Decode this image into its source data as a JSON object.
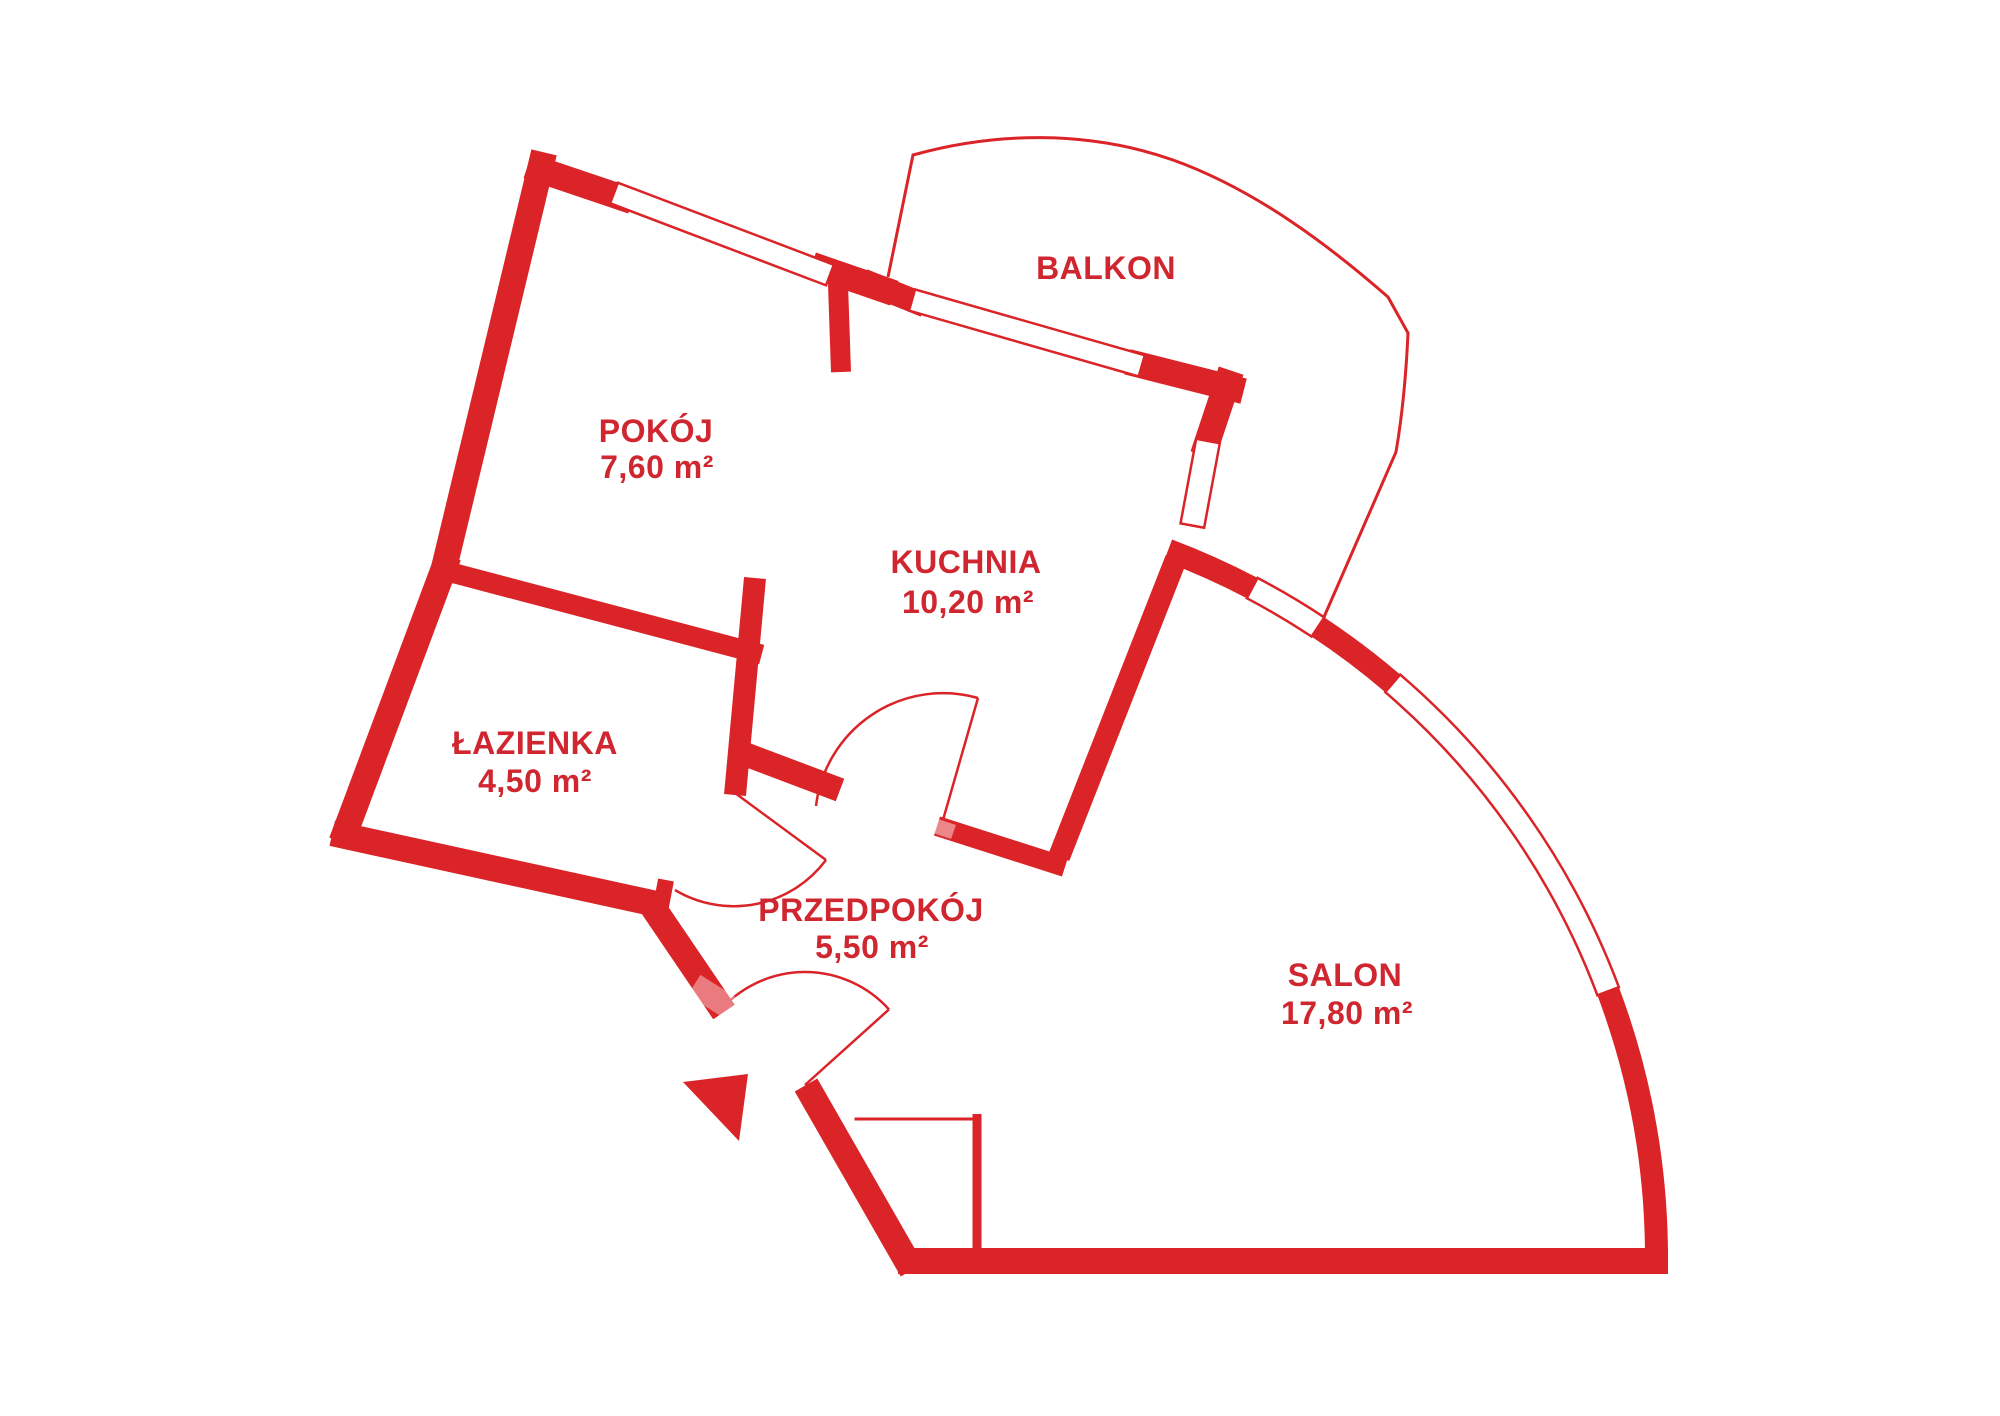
{
  "plan": {
    "background_color": "#ffffff",
    "accent_color": "#da2428",
    "rooms": [
      {
        "key": "balkon",
        "label": "BALKON",
        "area": ""
      },
      {
        "key": "pokoj",
        "label": "POKÓJ",
        "area": "7,60 m²"
      },
      {
        "key": "kuchnia",
        "label": "KUCHNIA",
        "area": "10,20 m²"
      },
      {
        "key": "lazienka",
        "label": "ŁAZIENKA",
        "area": "4,50 m²"
      },
      {
        "key": "przedpokoj",
        "label": "PRZEDPOKÓJ",
        "area": "5,50 m²"
      },
      {
        "key": "salon",
        "label": "SALON",
        "area": "17,80 m²"
      }
    ]
  }
}
